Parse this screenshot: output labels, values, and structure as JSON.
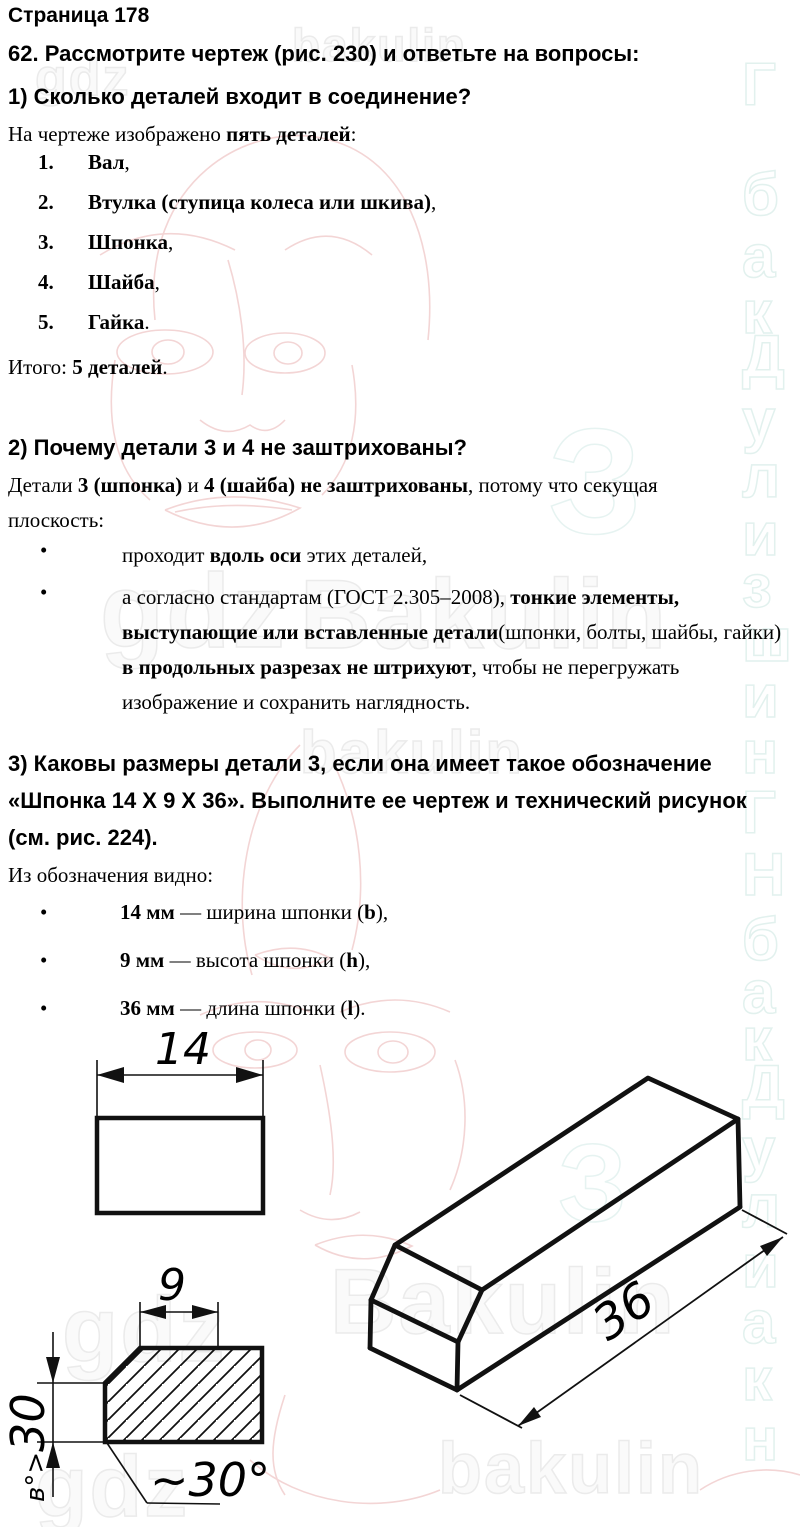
{
  "page": {
    "header": "Страница 178"
  },
  "q62": {
    "heading": "62. Рассмотрите чертеж (рис. 230) и ответьте на вопросы:"
  },
  "s1": {
    "heading": "1) Сколько деталей входит в соединение?",
    "intro": [
      {
        "t": "На чертеже изображено "
      },
      {
        "t": "пять деталей",
        "b": true
      },
      {
        "t": ":"
      }
    ],
    "items": [
      {
        "num": "1.",
        "rich": [
          {
            "t": "Вал",
            "b": true
          },
          {
            "t": ","
          }
        ]
      },
      {
        "num": "2.",
        "rich": [
          {
            "t": "Втулка (ступица колеса или шкива)",
            "b": true
          },
          {
            "t": ","
          }
        ]
      },
      {
        "num": "3.",
        "rich": [
          {
            "t": "Шпонка",
            "b": true
          },
          {
            "t": ","
          }
        ]
      },
      {
        "num": "4.",
        "rich": [
          {
            "t": "Шайба",
            "b": true
          },
          {
            "t": ","
          }
        ]
      },
      {
        "num": "5.",
        "rich": [
          {
            "t": "Гайка",
            "b": true
          },
          {
            "t": "."
          }
        ]
      }
    ],
    "total": [
      {
        "t": "Итого: "
      },
      {
        "t": "5 деталей",
        "b": true
      },
      {
        "t": "."
      }
    ]
  },
  "s2": {
    "heading": "2) Почему детали 3 и 4 не заштрихованы?",
    "para": [
      {
        "t": "Детали "
      },
      {
        "t": "3 (шпонка)",
        "b": true
      },
      {
        "t": " и "
      },
      {
        "t": "4 (шайба) не заштрихованы",
        "b": true
      },
      {
        "t": ", потому что секущая плоскость:"
      }
    ],
    "bullets": [
      {
        "rich": [
          {
            "t": "проходит "
          },
          {
            "t": "вдоль оси",
            "b": true
          },
          {
            "t": " этих деталей,"
          }
        ]
      },
      {
        "rich": [
          {
            "t": "а согласно стандартам (ГОСТ 2.305–2008), "
          },
          {
            "t": "тонкие элементы, выступающие или вставленные детали",
            "b": true
          },
          {
            "t": "(шпонки, болты, шайбы, гайки) "
          },
          {
            "t": "в продольных разрезах не штрихуют",
            "b": true
          },
          {
            "t": ", чтобы не перегружать изображение и сохранить наглядность."
          }
        ]
      }
    ]
  },
  "s3": {
    "heading": "3) Каковы размеры детали 3, если она имеет такое обозначение «Шпонка 14 X 9 X 36». Выполните ее чертеж и технический рисунок (см. рис. 224).",
    "intro": "Из обозначения видно:",
    "bullets": [
      {
        "rich": [
          {
            "t": "14 мм",
            "b": true
          },
          {
            "t": " — ширина шпонки ("
          },
          {
            "t": "b",
            "b": true
          },
          {
            "t": "),"
          }
        ]
      },
      {
        "rich": [
          {
            "t": "9 мм",
            "b": true
          },
          {
            "t": " — высота шпонки ("
          },
          {
            "t": "h",
            "b": true
          },
          {
            "t": "),"
          }
        ]
      },
      {
        "rich": [
          {
            "t": "36 мм",
            "b": true
          },
          {
            "t": " — длина шпонки ("
          },
          {
            "t": "l",
            "b": true
          },
          {
            "t": ")."
          }
        ]
      }
    ]
  },
  "drawings": {
    "front_view": {
      "width_label": "14"
    },
    "section_view": {
      "top_label": "9",
      "side_label_small": "в°>",
      "side_label_big": "30",
      "chamfer_label": "~30°"
    },
    "iso_view": {
      "length_label": "36"
    }
  },
  "watermarks": {
    "strip_letters": [
      {
        "ch": "Г"
      },
      {
        "ch": "б"
      },
      {
        "ch": "а"
      },
      {
        "ch": "к"
      },
      {
        "ch": "Д"
      },
      {
        "ch": "у"
      },
      {
        "ch": "л"
      },
      {
        "ch": "и"
      },
      {
        "ch": "з"
      },
      {
        "ch": "ш"
      },
      {
        "ch": "и"
      },
      {
        "ch": "н"
      },
      {
        "ch": "Г"
      },
      {
        "ch": "Н"
      },
      {
        "ch": "б"
      },
      {
        "ch": "а"
      },
      {
        "ch": "к"
      },
      {
        "ch": "Д"
      },
      {
        "ch": "у"
      },
      {
        "ch": "л"
      },
      {
        "ch": "и"
      },
      {
        "ch": "а"
      },
      {
        "ch": "к"
      },
      {
        "ch": "н"
      }
    ],
    "texts": [
      {
        "t": "gdz"
      },
      {
        "t": "bakulin"
      },
      {
        "t": "gdz"
      },
      {
        "t": "Bakulin"
      },
      {
        "t": "bakulin"
      },
      {
        "t": "З"
      },
      {
        "t": "gdz"
      },
      {
        "t": "Bakulin"
      },
      {
        "t": "З"
      },
      {
        "t": "bakulin"
      },
      {
        "t": "gdz"
      }
    ]
  }
}
